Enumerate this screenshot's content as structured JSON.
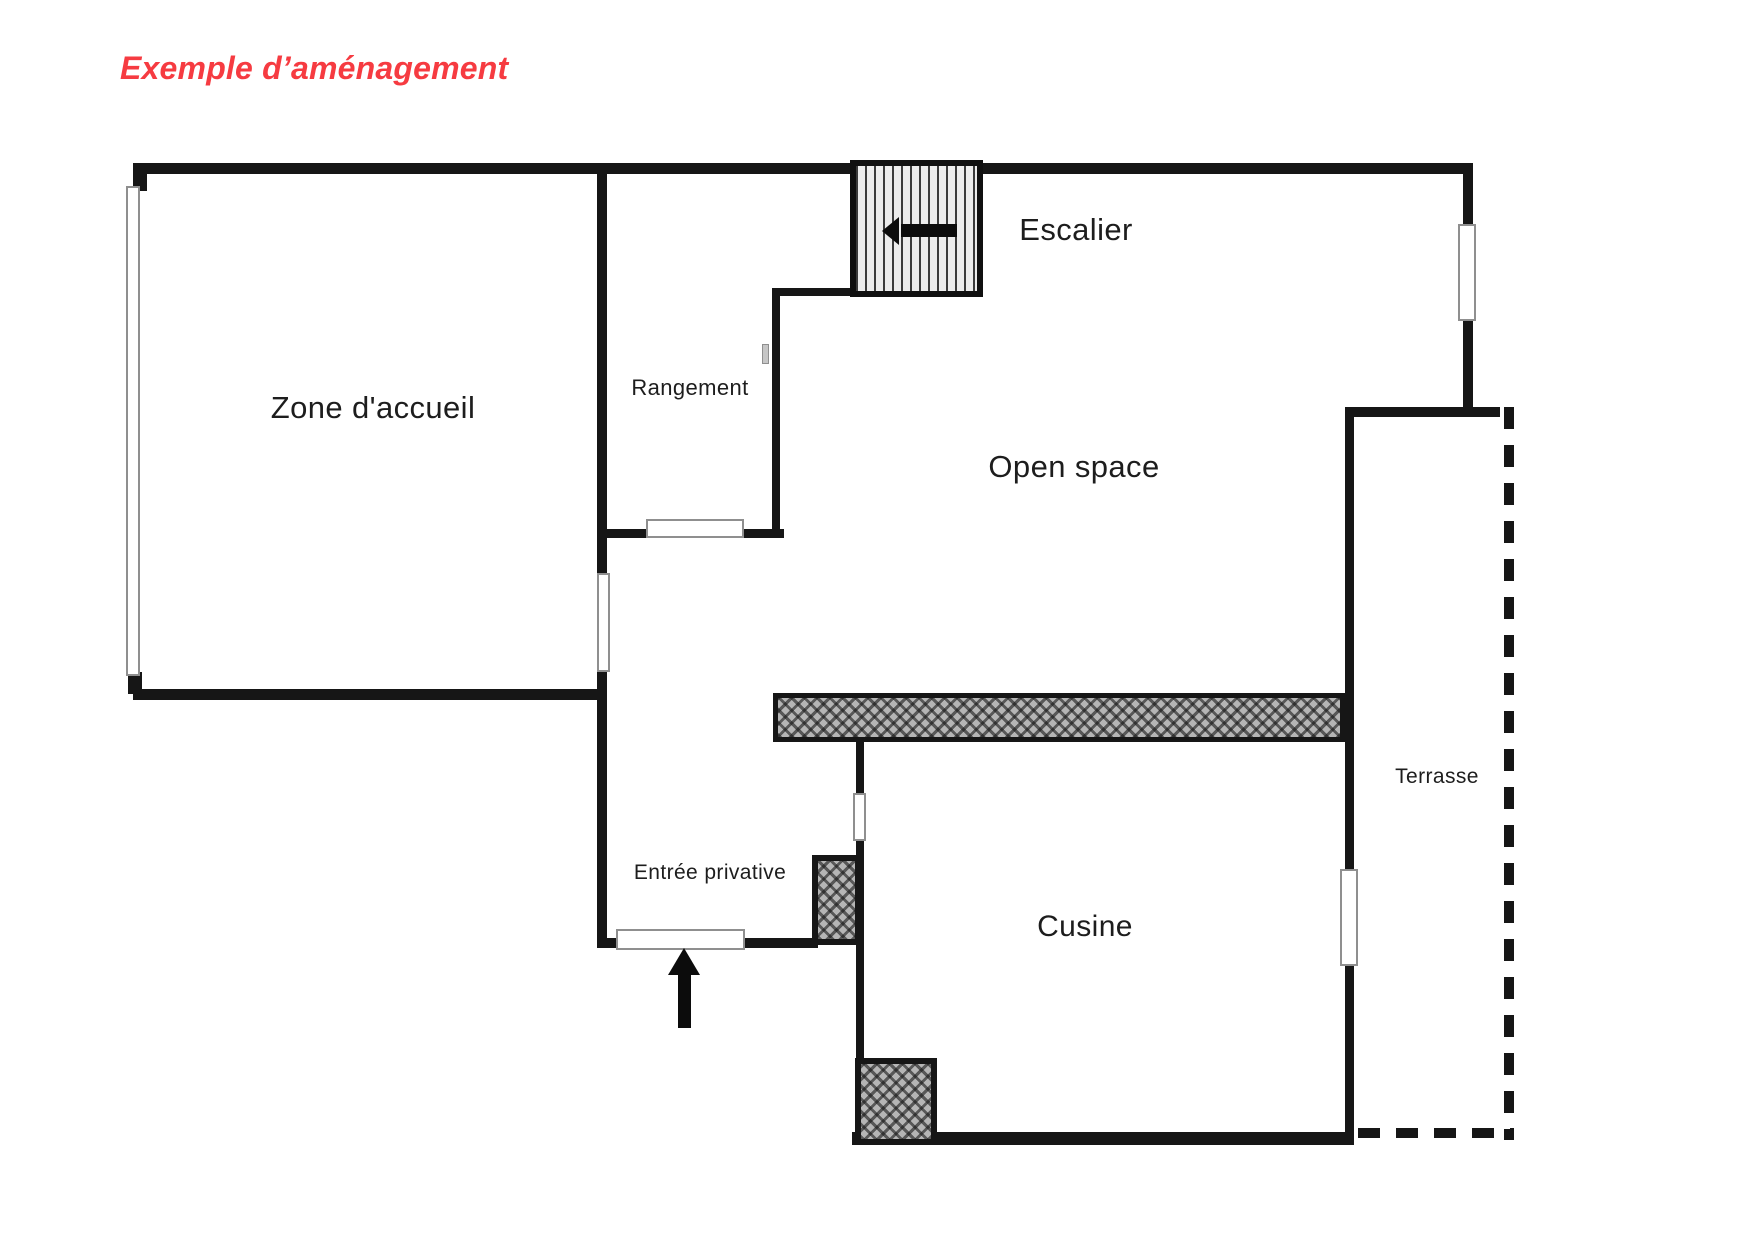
{
  "title": "Exemple d’aménagement",
  "colors": {
    "accent": "#f63b41",
    "wall": "#161616",
    "label": "#1d1d1d",
    "window_border": "#8f8f8f",
    "hatch_gray": "#b5b5b5",
    "stairs_bg": "#ededed"
  },
  "labels": {
    "zone_accueil": "Zone d'accueil",
    "rangement": "Rangement",
    "escalier": "Escalier",
    "open_space": "Open space",
    "entree_privative": "Entrée privative",
    "cusine": "Cusine",
    "terrasse": "Terrasse"
  }
}
